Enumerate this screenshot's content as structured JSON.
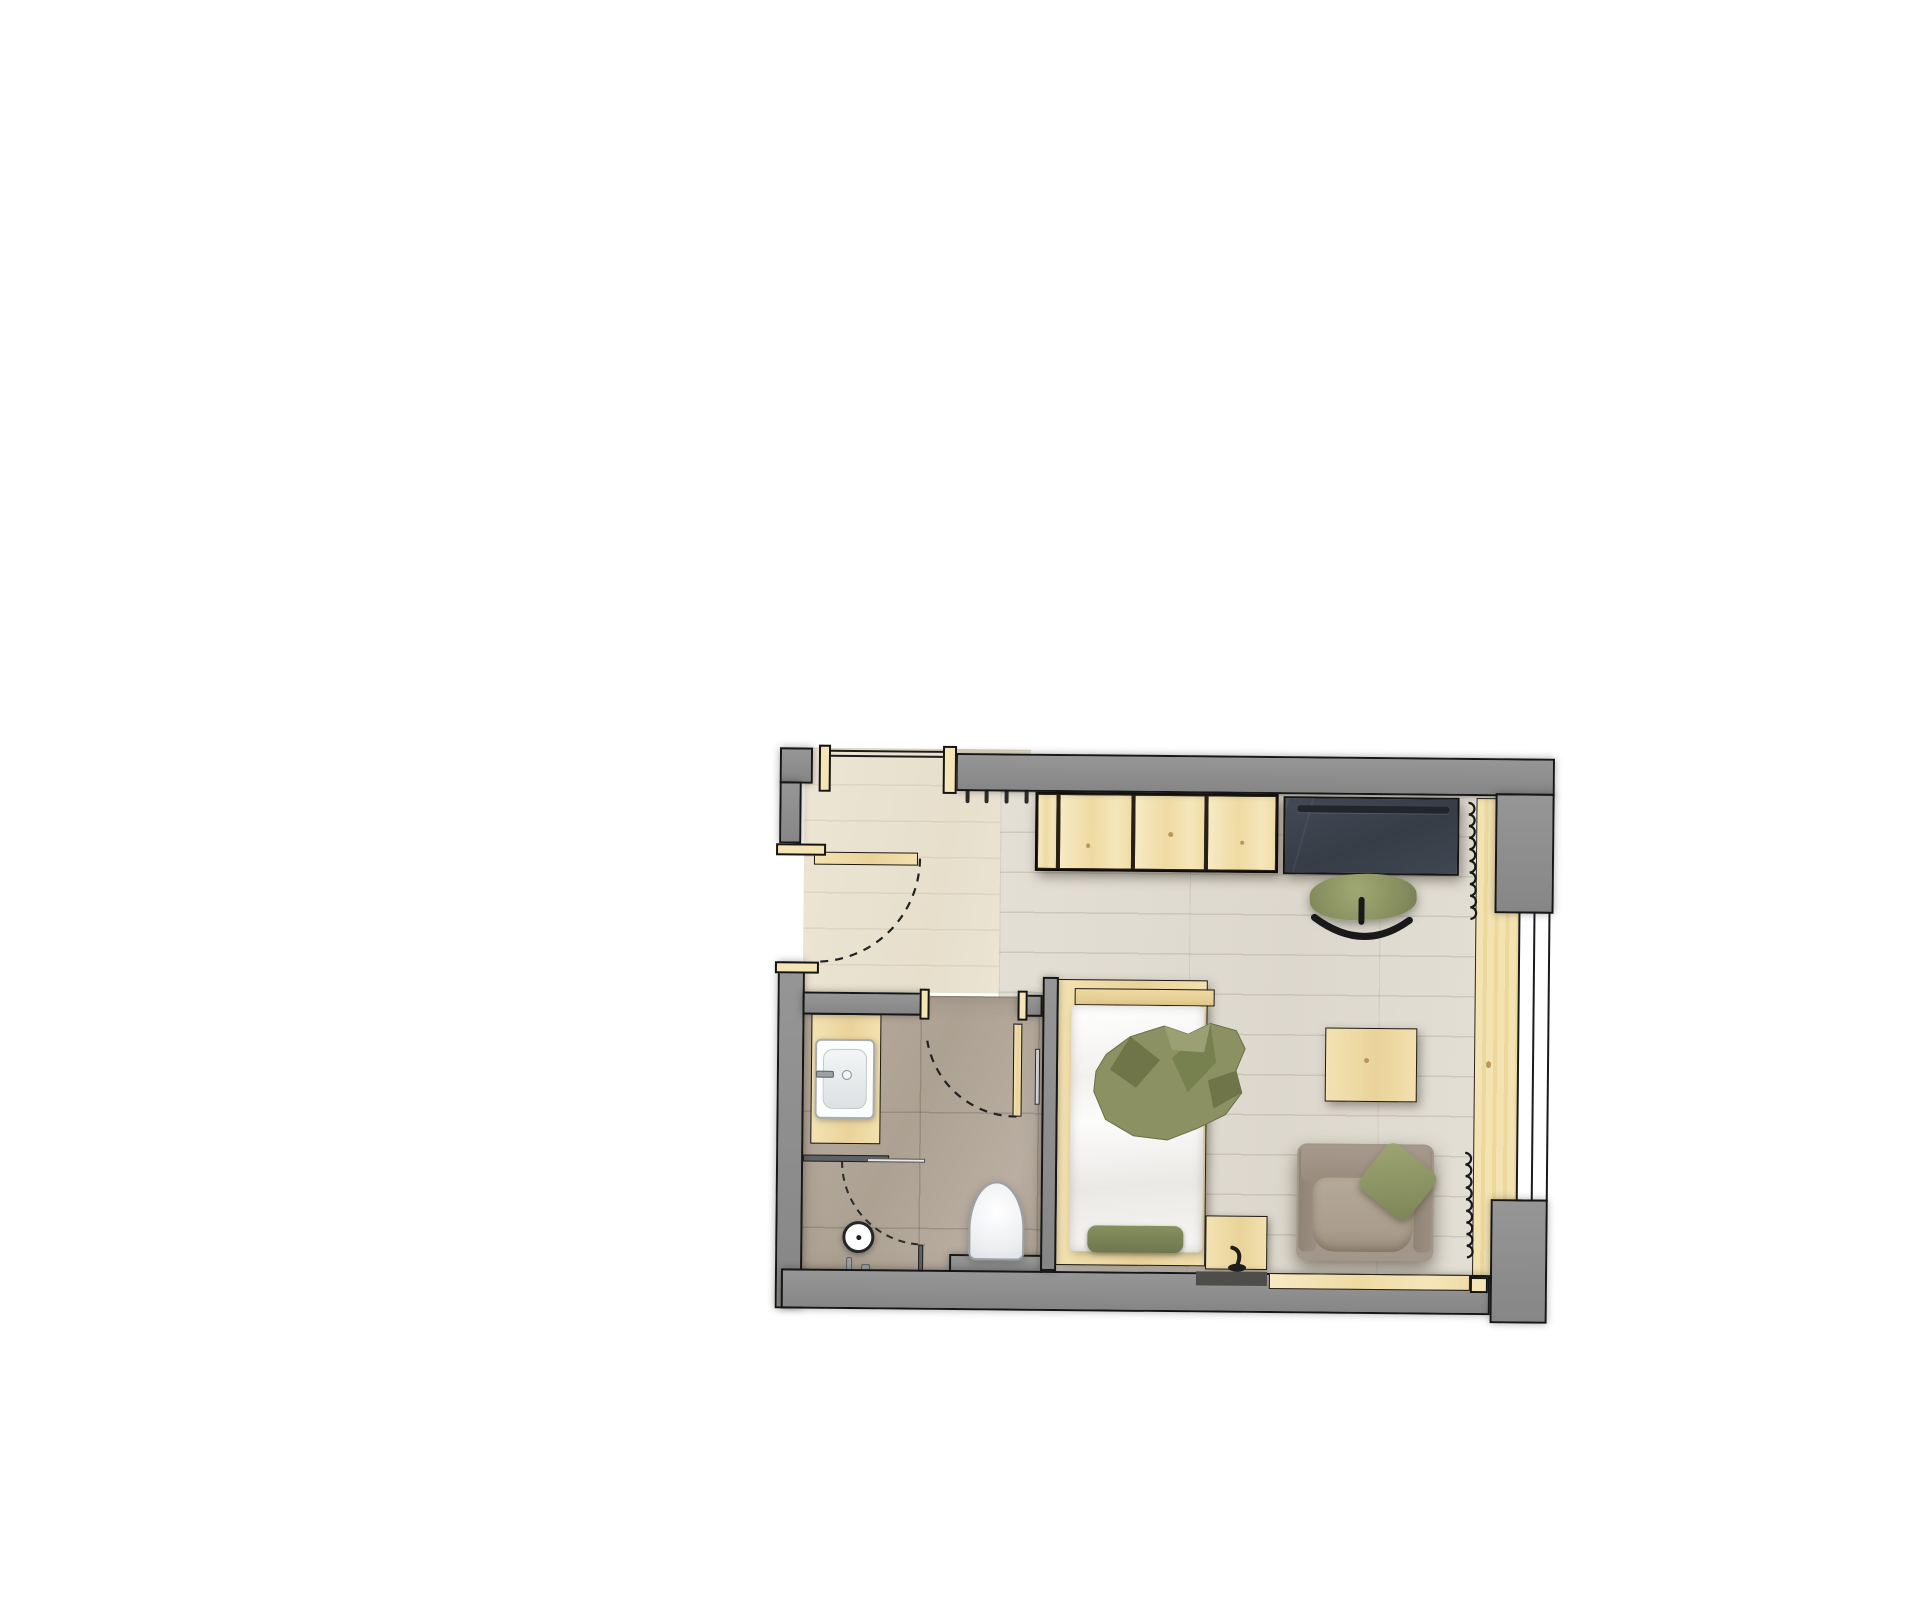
{
  "meta": {
    "description": "Hotel room floor plan, top view: entry hall with wardrobe and desk, bedroom with single bed, side table and armchair, bathroom with vanity sink, walk-in shower and toilet. No visible text labels.",
    "background": "#ffffff"
  },
  "colors": {
    "wall": "#8b8b8b",
    "outline": "#161616",
    "pine": "#f1dfae",
    "entry_floor": "#e9e2d1",
    "bedroom_floor": "#e0dcd2",
    "bath_floor": "#b2a79a",
    "desk_slate": "#3e4450",
    "green": "#8b9162",
    "green_dark": "#6f7549",
    "green_light": "#9aa073",
    "taupe": "#a3968a",
    "fixture_white": "#fcfcfc"
  },
  "plan": {
    "origin": {
      "left": 770,
      "top": 740,
      "width": 790,
      "height": 590,
      "rotation_deg": 0.55
    },
    "items": [
      {
        "name": "floor-entry-hall",
        "cls": "f-entry z1",
        "x": 34,
        "y": 11,
        "w": 226,
        "h": 244
      },
      {
        "name": "floor-bedroom",
        "cls": "f-bed z1",
        "x": 230,
        "y": 53,
        "w": 521,
        "h": 479
      },
      {
        "name": "floor-bathroom",
        "cls": "f-bath z1",
        "x": 34,
        "y": 258,
        "w": 242,
        "h": 278
      },
      {
        "name": "window-sill-board",
        "cls": "sill z1",
        "x": 706,
        "y": 55,
        "w": 45,
        "h": 481
      },
      {
        "name": "sill-knot",
        "cls": "knot z1",
        "x": 718,
        "y": 318,
        "w": 5,
        "h": 7
      },
      {
        "name": "door-entry-swing-arc",
        "svg": "path",
        "layer": "under",
        "d": "M 150,121 A 104,104 0 0 1 46,225",
        "stroke": "#222222",
        "sw": 2.2,
        "dash": "8,7",
        "fill": "none"
      },
      {
        "name": "door-bath-swing-arc",
        "svg": "path",
        "layer": "under",
        "d": "M 249,378 A 91,91 0 0 1 159,303",
        "stroke": "#222222",
        "sw": 2.2,
        "dash": "8,7",
        "fill": "none"
      },
      {
        "name": "shower-door-arc",
        "svg": "path",
        "layer": "under",
        "d": "M 75,424 A 83,83 0 0 0 158,507",
        "stroke": "#2a2a2a",
        "sw": 2,
        "dash": "7,6",
        "fill": "none"
      },
      {
        "name": "radiator-coil-upper",
        "svg": "coil",
        "layer": "under",
        "x": 698,
        "y0": 60,
        "y1": 180,
        "r": 5.2,
        "step": 11.6,
        "stroke": "#191919",
        "sw": 2.2,
        "fill": "none"
      },
      {
        "name": "radiator-coil-lower",
        "svg": "coil",
        "layer": "under",
        "x": 698,
        "y0": 410,
        "y1": 526,
        "r": 5.2,
        "step": 11.6,
        "stroke": "#191919",
        "sw": 2.2,
        "fill": "none"
      },
      {
        "name": "coat-hook-1",
        "cls": "hook z3",
        "x": 195,
        "y": 51,
        "w": 4,
        "h": 14
      },
      {
        "name": "coat-hook-2",
        "cls": "hook z3",
        "x": 214,
        "y": 51,
        "w": 4,
        "h": 14
      },
      {
        "name": "coat-hook-3",
        "cls": "hook z3",
        "x": 234,
        "y": 51,
        "w": 4,
        "h": 14
      },
      {
        "name": "coat-hook-4",
        "cls": "hook z3",
        "x": 254,
        "y": 51,
        "w": 4,
        "h": 14
      },
      {
        "name": "wardrobe",
        "cls": "wd z3",
        "x": 265,
        "y": 53,
        "w": 243,
        "h": 79
      },
      {
        "name": "wardrobe-side-panel",
        "cls": "pine2 z3",
        "x": 267,
        "y": 55,
        "w": 20,
        "h": 75
      },
      {
        "name": "wardrobe-door-1",
        "cls": "pine2 z3",
        "x": 289,
        "y": 55,
        "w": 73,
        "h": 75
      },
      {
        "name": "wardrobe-door-2",
        "cls": "pine2 z3",
        "x": 364,
        "y": 55,
        "w": 71,
        "h": 75
      },
      {
        "name": "wardrobe-door-3",
        "cls": "pine2 z3",
        "x": 437,
        "y": 55,
        "w": 69,
        "h": 75
      },
      {
        "name": "wardrobe-knot-1",
        "cls": "knot z3",
        "x": 316,
        "y": 104,
        "w": 4,
        "h": 5
      },
      {
        "name": "wardrobe-knot-2",
        "cls": "knot z3",
        "x": 398,
        "y": 92,
        "w": 5,
        "h": 5
      },
      {
        "name": "wardrobe-knot-3",
        "cls": "knot z3",
        "x": 470,
        "y": 100,
        "w": 4,
        "h": 4
      },
      {
        "name": "desk",
        "cls": "desk z3",
        "x": 513,
        "y": 55,
        "w": 176,
        "h": 78
      },
      {
        "name": "desk-pen-tray",
        "cls": "tray z3",
        "x": 527,
        "y": 64,
        "w": 152,
        "h": 7
      },
      {
        "name": "desk-chair-seat",
        "cls": "chairseat z3",
        "x": 540,
        "y": 132,
        "w": 107,
        "h": 46
      },
      {
        "name": "bed-frame",
        "cls": "pine3 z3",
        "x": 289,
        "y": 240,
        "w": 150,
        "h": 286,
        "style": "box-shadow:3px 4px 10px rgba(70,62,48,.45);"
      },
      {
        "name": "bed-headboard",
        "cls": "pine3b z3",
        "x": 306,
        "y": 249,
        "w": 140,
        "h": 17
      },
      {
        "name": "bed-mattress",
        "cls": "mattress z3",
        "x": 303,
        "y": 266,
        "w": 133,
        "h": 246
      },
      {
        "name": "bed-foot-cushion",
        "cls": "cushion z3",
        "x": 321,
        "y": 486,
        "w": 96,
        "h": 27
      },
      {
        "name": "nightstand",
        "cls": "pine3 z3",
        "x": 439,
        "y": 475,
        "w": 62,
        "h": 54,
        "style": "box-shadow:2px 3px 8px rgba(70,62,48,.5);"
      },
      {
        "name": "side-table",
        "cls": "pine3 z3",
        "x": 557,
        "y": 286,
        "w": 92,
        "h": 74,
        "style": "box-shadow:3px 4px 10px rgba(70,62,48,.5);"
      },
      {
        "name": "side-table-knot",
        "cls": "knot z3",
        "x": 596,
        "y": 316,
        "w": 5,
        "h": 5
      },
      {
        "name": "armchair-body",
        "cls": "armbase z3",
        "x": 530,
        "y": 402,
        "w": 137,
        "h": 117
      },
      {
        "name": "armchair-arm-left",
        "cls": "armdark z3",
        "x": 532,
        "y": 406,
        "w": 18,
        "h": 104
      },
      {
        "name": "armchair-arm-right",
        "cls": "armdark z3",
        "x": 647,
        "y": 406,
        "w": 18,
        "h": 104
      },
      {
        "name": "armchair-back",
        "cls": "armmid z3",
        "x": 534,
        "y": 404,
        "w": 129,
        "h": 36
      },
      {
        "name": "armchair-seat-cushion",
        "cls": "armseat z3",
        "x": 546,
        "y": 436,
        "w": 100,
        "h": 74
      },
      {
        "name": "armchair-pillow",
        "cls": "pillow z3",
        "x": 600,
        "y": 410,
        "w": 62,
        "h": 58
      },
      {
        "name": "vanity-counter",
        "cls": "pine3 z3",
        "x": 43,
        "y": 277,
        "w": 70,
        "h": 130
      },
      {
        "name": "sink-basin",
        "cls": "sink z3",
        "x": 47,
        "y": 302,
        "w": 60,
        "h": 80
      },
      {
        "name": "sink-inner-bowl",
        "cls": "sinkin z3",
        "x": 55,
        "y": 312,
        "w": 44,
        "h": 60
      },
      {
        "name": "sink-faucet-handle",
        "cls": "metal z3",
        "x": 48,
        "y": 334,
        "w": 18,
        "h": 7
      },
      {
        "name": "sink-drain",
        "cls": "drain z3",
        "x": 74,
        "y": 333,
        "w": 10,
        "h": 10
      },
      {
        "name": "shower-partition",
        "cls": "glassdark z3",
        "x": 36,
        "y": 418,
        "w": 86,
        "h": 7
      },
      {
        "name": "shower-partition-glass",
        "cls": "glasslight z3",
        "x": 100,
        "y": 421,
        "w": 58,
        "h": 4
      },
      {
        "name": "shower-return-panel",
        "cls": "glassdark z3",
        "x": 152,
        "y": 507,
        "w": 5,
        "h": 31
      },
      {
        "name": "shower-head",
        "cls": "showerhead z3",
        "x": 76,
        "y": 484,
        "w": 32,
        "h": 32
      },
      {
        "name": "shower-head-dot",
        "cls": "dot z3",
        "x": 90,
        "y": 498,
        "w": 5,
        "h": 5
      },
      {
        "name": "shower-valve-1",
        "cls": "metal z3",
        "x": 80,
        "y": 520,
        "w": 6,
        "h": 16
      },
      {
        "name": "shower-valve-2",
        "cls": "metal z3",
        "x": 95,
        "y": 527,
        "w": 9,
        "h": 11
      },
      {
        "name": "towel-rail",
        "cls": "rail z3",
        "x": 267,
        "y": 310,
        "w": 5,
        "h": 56
      },
      {
        "name": "wall-toilet-plinth",
        "cls": "w z3",
        "x": 183,
        "y": 516,
        "w": 93,
        "h": 26
      },
      {
        "name": "toilet",
        "cls": "toilet z3",
        "x": 202,
        "y": 443,
        "w": 56,
        "h": 79
      },
      {
        "name": "door-entry-leaf",
        "cls": "pine3 z3",
        "x": 44,
        "y": 115,
        "w": 104,
        "h": 13
      },
      {
        "name": "door-bath-leaf",
        "cls": "pine3 z3",
        "x": 245,
        "y": 285,
        "w": 9,
        "h": 93
      },
      {
        "name": "window-glazing",
        "cls": "win z3",
        "x": 749,
        "y": 168,
        "w": 32,
        "h": 290
      },
      {
        "name": "window-mullion",
        "cls": "line z3",
        "x": 764,
        "y": 168,
        "w": 2,
        "h": 290
      },
      {
        "name": "wall-left-upper",
        "cls": "w z4",
        "x": 9,
        "y": 11,
        "w": 33,
        "h": 36
      },
      {
        "name": "wall-left-mid",
        "cls": "w z4",
        "x": 9,
        "y": 45,
        "w": 22,
        "h": 62
      },
      {
        "name": "wall-left-lower",
        "cls": "w z4",
        "x": 9,
        "y": 225,
        "w": 27,
        "h": 347
      },
      {
        "name": "wall-top",
        "cls": "w z4",
        "x": 185,
        "y": 15,
        "w": 599,
        "h": 38
      },
      {
        "name": "wall-top-right-corner",
        "cls": "w z4",
        "x": 725,
        "y": 50,
        "w": 59,
        "h": 120
      },
      {
        "name": "wall-bottom",
        "cls": "w z4",
        "x": 15,
        "y": 532,
        "w": 709,
        "h": 40
      },
      {
        "name": "wall-bottom-right-corner",
        "cls": "w z4",
        "x": 724,
        "y": 456,
        "w": 57,
        "h": 124
      },
      {
        "name": "wall-bathroom-top",
        "cls": "w z4",
        "x": 34,
        "y": 255,
        "w": 122,
        "h": 23
      },
      {
        "name": "wall-bathroom-stub",
        "cls": "w z4",
        "x": 249,
        "y": 256,
        "w": 25,
        "h": 22
      },
      {
        "name": "wall-divider",
        "cls": "w z4",
        "x": 274,
        "y": 238,
        "w": 16,
        "h": 294
      },
      {
        "name": "jamb-entry-niche-left",
        "cls": "jamb z4",
        "x": 48,
        "y": 8,
        "w": 12,
        "h": 47
      },
      {
        "name": "jamb-entry-niche-right",
        "cls": "jamb z4",
        "x": 172,
        "y": 8,
        "w": 14,
        "h": 48
      },
      {
        "name": "niche-lintel-line-outer",
        "cls": "line z4",
        "x": 60,
        "y": 13,
        "w": 112,
        "h": 2
      },
      {
        "name": "niche-lintel-line-inner",
        "cls": "line z4",
        "x": 60,
        "y": 18,
        "w": 112,
        "h": 2
      },
      {
        "name": "jamb-entry-door-top",
        "cls": "jamb z4",
        "x": 6,
        "y": 107,
        "w": 50,
        "h": 12
      },
      {
        "name": "jamb-entry-door-bottom",
        "cls": "jamb z4",
        "x": 6,
        "y": 225,
        "w": 44,
        "h": 12
      },
      {
        "name": "jamb-bath-door-left",
        "cls": "jamb z4",
        "x": 151,
        "y": 251,
        "w": 10,
        "h": 31
      },
      {
        "name": "jamb-bath-door-right",
        "cls": "jamb z4",
        "x": 249,
        "y": 252,
        "w": 10,
        "h": 30
      },
      {
        "name": "jamb-sill-end-cap",
        "cls": "jamb z4",
        "x": 704,
        "y": 534,
        "w": 18,
        "h": 16
      },
      {
        "name": "nightstand-shelf-shadow",
        "cls": "darkstrip z5",
        "x": 430,
        "y": 531,
        "w": 71,
        "h": 14
      },
      {
        "name": "bench-plank",
        "cls": "pine2 z5",
        "x": 503,
        "y": 532,
        "w": 201,
        "h": 16
      },
      {
        "name": "bed-throw-blanket",
        "svg": "polygon",
        "layer": "over",
        "points": "338,315 362,297 396,286 420,294 442,283 468,290 477,308 468,330 474,352 458,374 430,388 400,400 366,396 338,380 326,352 328,332",
        "fill": "#8b9162",
        "stroke": "#6a7047",
        "sw": 1
      },
      {
        "name": "bed-throw-fold-1",
        "svg": "polygon",
        "layer": "over",
        "points": "362,297 392,320 368,348 342,330",
        "fill": "#6f7549",
        "stroke": "none",
        "sw": 0
      },
      {
        "name": "bed-throw-fold-2",
        "svg": "polygon",
        "layer": "over",
        "points": "442,283 448,322 420,352 404,318",
        "fill": "#77804f",
        "stroke": "none",
        "sw": 0
      },
      {
        "name": "bed-throw-fold-3",
        "svg": "polygon",
        "layer": "over",
        "points": "468,330 474,352 446,368 440,340",
        "fill": "#6f7549",
        "stroke": "none",
        "sw": 0
      },
      {
        "name": "bed-throw-highlight",
        "svg": "polygon",
        "layer": "over",
        "points": "396,286 420,294 442,283 436,312 404,310",
        "fill": "#9aa073",
        "stroke": "none",
        "sw": 0
      },
      {
        "name": "desk-chair-rocker-rail",
        "svg": "path",
        "layer": "over",
        "d": "M 545,176 Q 594,212 640,178",
        "stroke": "#191919",
        "sw": 7,
        "fill": "none",
        "cap": "round"
      },
      {
        "name": "desk-chair-post",
        "svg": "path",
        "layer": "over",
        "d": "M 592,158 L 592,180",
        "stroke": "#191919",
        "sw": 6,
        "fill": "none",
        "cap": "round"
      },
      {
        "name": "table-lamp-stem",
        "svg": "path",
        "layer": "over",
        "d": "M 466,507 Q 477,510 471,525",
        "stroke": "#1d1d1d",
        "sw": 4,
        "fill": "none",
        "cap": "round"
      },
      {
        "name": "table-lamp-base",
        "svg": "ellipse",
        "layer": "over",
        "cx": 471,
        "cy": 527,
        "rx": 9,
        "ry": 4,
        "fill": "#1d1d1d"
      }
    ]
  }
}
